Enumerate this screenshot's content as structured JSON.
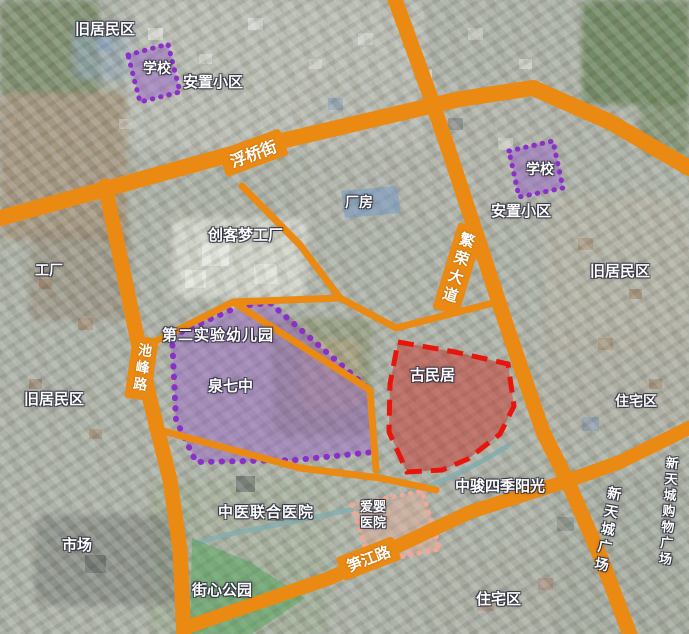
{
  "road_labels": [
    {
      "id": "fuqiao-street",
      "text": "浮桥街"
    },
    {
      "id": "fanrong-avenue",
      "text": "繁荣大道"
    },
    {
      "id": "chifeng-road",
      "text": "池峰路"
    },
    {
      "id": "sunjiang-road",
      "text": "笋江路"
    }
  ],
  "place_labels": [
    {
      "id": "old-residential-topleft",
      "text": "旧居民区"
    },
    {
      "id": "school-topleft",
      "text": "学校"
    },
    {
      "id": "resettlement-community-topleft",
      "text": "安置小区"
    },
    {
      "id": "factory-building",
      "text": "厂房"
    },
    {
      "id": "maker-dream-factory",
      "text": "创客梦工厂"
    },
    {
      "id": "school-topright",
      "text": "学校"
    },
    {
      "id": "resettlement-community-right",
      "text": "安置小区"
    },
    {
      "id": "old-residential-right",
      "text": "旧居民区"
    },
    {
      "id": "factory-left",
      "text": "工厂"
    },
    {
      "id": "no2-experimental-kindergarten",
      "text": "第二实验幼儿园"
    },
    {
      "id": "quanzhou-no7-middle-school",
      "text": "泉七中"
    },
    {
      "id": "old-residential-left",
      "text": "旧居民区"
    },
    {
      "id": "ancient-dwellings",
      "text": "古民居"
    },
    {
      "id": "residential-right",
      "text": "住宅区"
    },
    {
      "id": "zhongjun-four-seasons-sunshine",
      "text": "中骏四季阳光"
    },
    {
      "id": "tcm-united-hospital",
      "text": "中医联合医院"
    },
    {
      "id": "aiying-hospital",
      "text": "爱婴医院"
    },
    {
      "id": "market",
      "text": "市场"
    },
    {
      "id": "street-center-park",
      "text": "街心公园"
    },
    {
      "id": "residential-bottom",
      "text": "住宅区"
    },
    {
      "id": "xintiancheng-plaza",
      "text": "新天城广场"
    },
    {
      "id": "xintiancheng-shopping-plaza",
      "text": "新天城购物广场"
    }
  ],
  "colors": {
    "road": "#EA8A12",
    "school_zone_fill": "rgba(150,90,205,0.45)",
    "school_zone_border": "#8B2FC9",
    "heritage_zone_fill": "rgba(200,45,38,0.48)",
    "heritage_zone_border": "#E8150C",
    "hospital_zone_fill": "rgba(238,172,150,0.40)",
    "hospital_zone_border": "#F2A896",
    "park_zone_fill": "rgba(70,165,85,0.45)",
    "factory_highlight_fill": "rgba(110,150,200,0.50)",
    "label_text": "#FFFFFF"
  }
}
